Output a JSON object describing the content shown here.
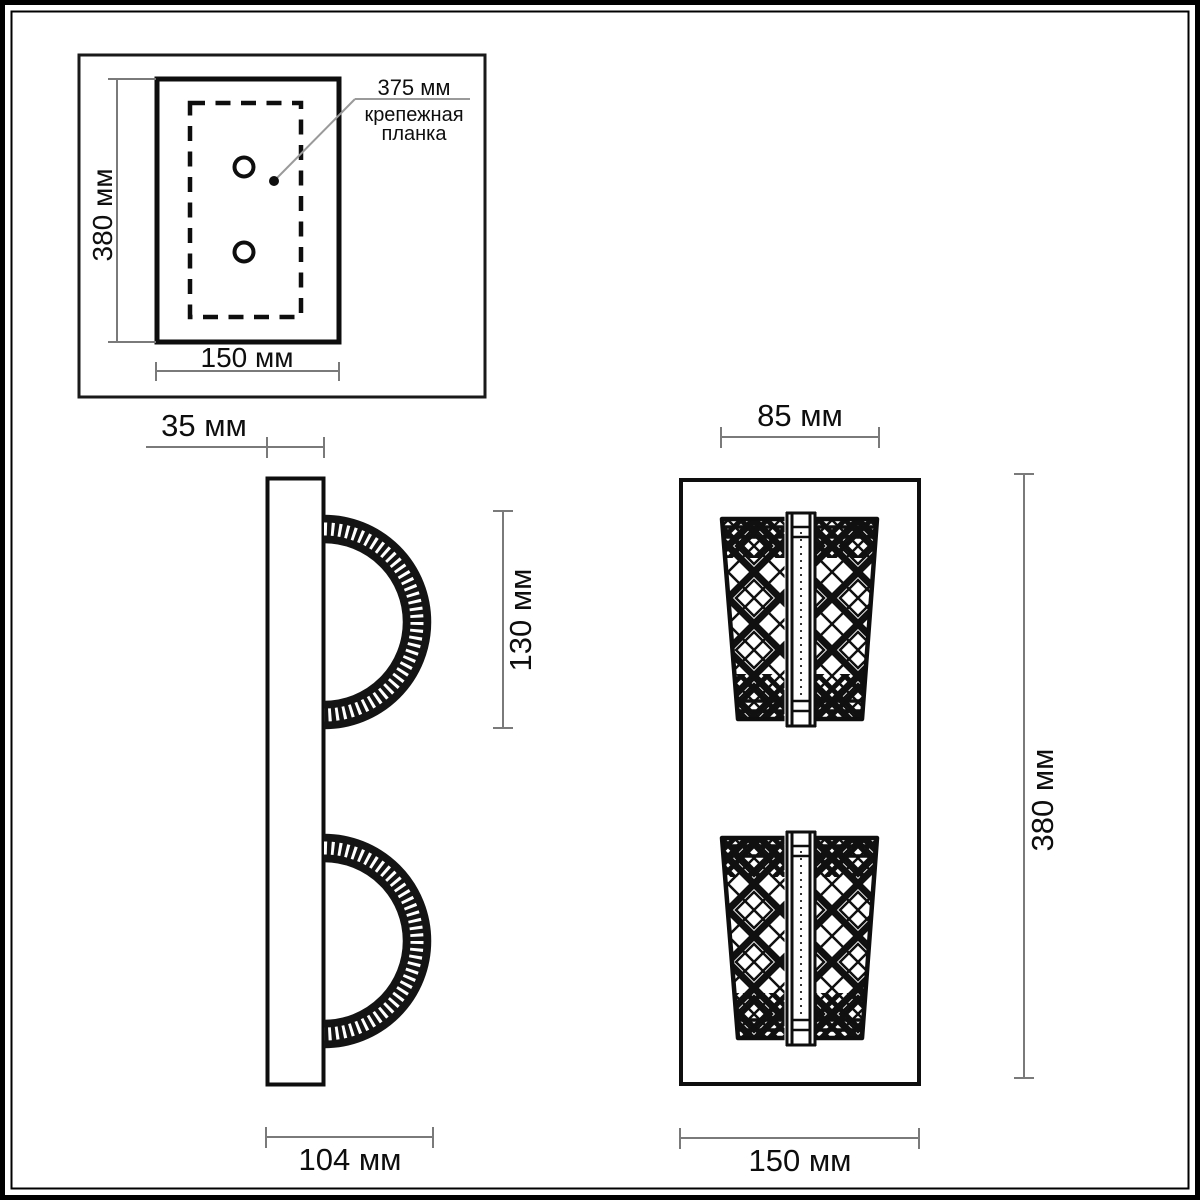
{
  "drawing": {
    "title": "wall-sconce-dimension-drawing",
    "mount_view": {
      "height_label": "380 мм",
      "width_label": "150 мм",
      "bracket": {
        "length_label": "375 мм",
        "caption_line1": "крепежная",
        "caption_line2": "планка"
      }
    },
    "side_view": {
      "plate_depth_label": "35 мм",
      "lamp_height_label": "130 мм",
      "total_depth_label": "104 мм"
    },
    "front_view": {
      "shade_width_label": "85 мм",
      "total_height_label": "380 мм",
      "width_label": "150 мм"
    },
    "colors": {
      "object_line": "#0e0e0e",
      "dimension_line": "#7a7a7a",
      "leader_line": "#9a9a9a",
      "background": "#ffffff"
    }
  }
}
